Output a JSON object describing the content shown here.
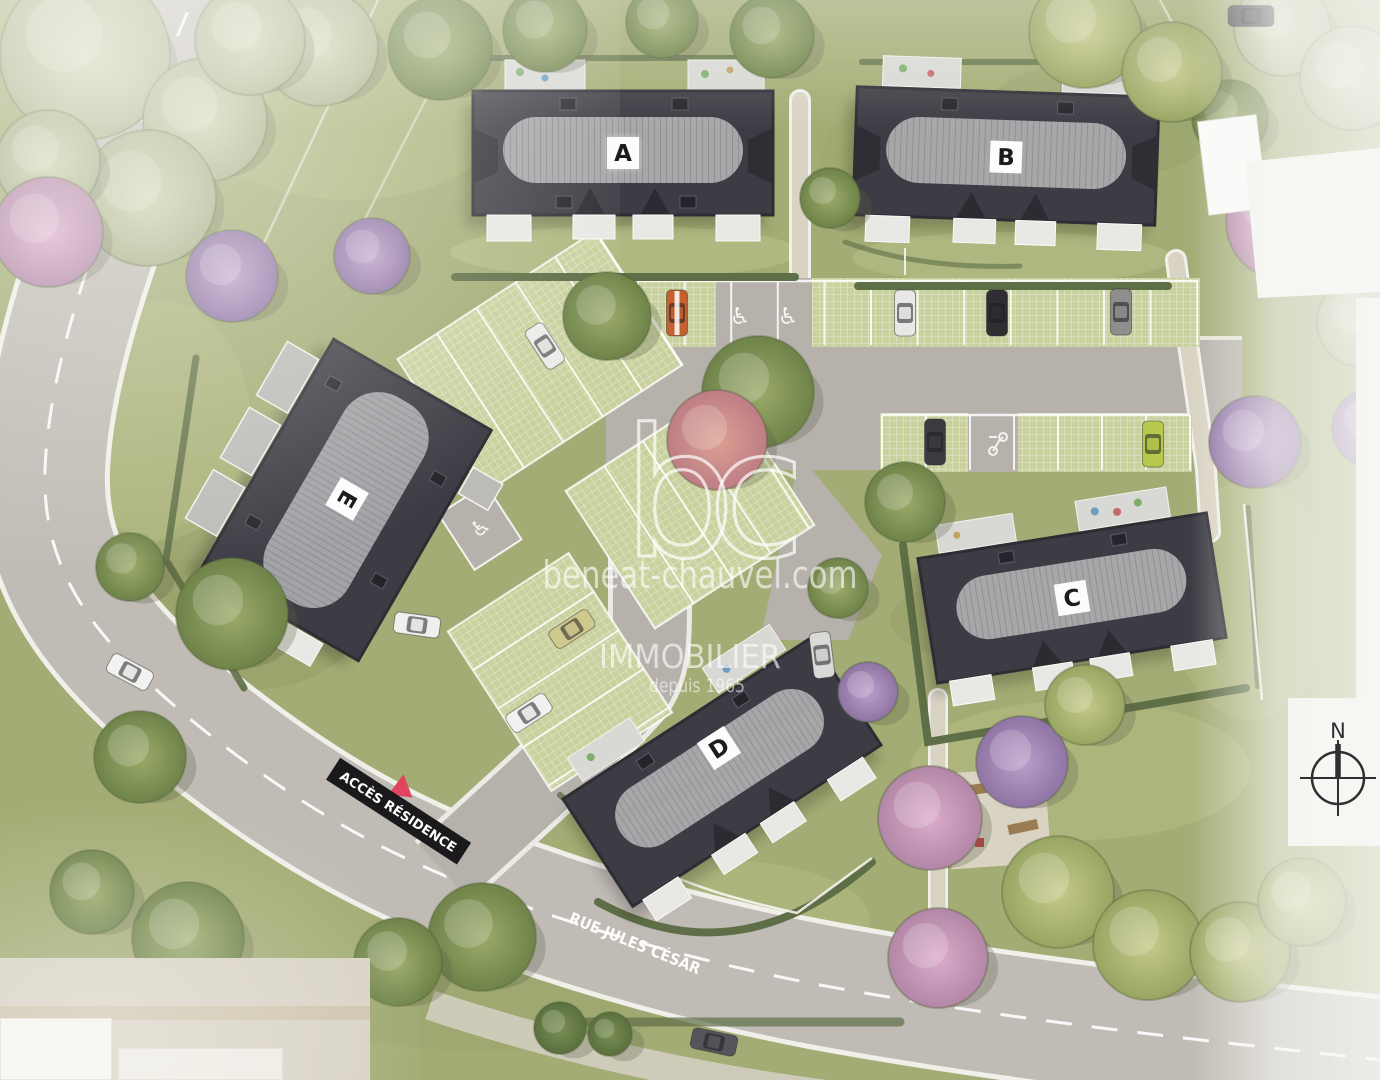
{
  "plan": {
    "buildings": [
      {
        "id": "A",
        "label": "A"
      },
      {
        "id": "B",
        "label": "B"
      },
      {
        "id": "C",
        "label": "C"
      },
      {
        "id": "D",
        "label": "D"
      },
      {
        "id": "E",
        "label": "E"
      }
    ],
    "signs": {
      "access_residence": "ACCÈS RÉSIDENCE",
      "street_name": "RUE JULES CÉSAR"
    },
    "watermark": {
      "logo": "bc",
      "website": "beneat-chauvel.com",
      "brand": "IMMOBILIER",
      "since": "depuis 1965"
    },
    "compass": {
      "north": "N"
    },
    "icons": {
      "accessible_parking": "♿"
    },
    "colors": {
      "roof_dark": "#3d3c44",
      "roof_ridge": "#a6a7a9",
      "grass": "#a3ac74",
      "paver_green": "#c9d19e",
      "asphalt": "#beb9b2",
      "hedge": "#5e6e46",
      "accent_red": "#e0445f",
      "watermark_white": "rgba(255,255,255,0.65)",
      "label_bg": "#fcfcfc",
      "label_text": "#1c1c1f"
    }
  }
}
